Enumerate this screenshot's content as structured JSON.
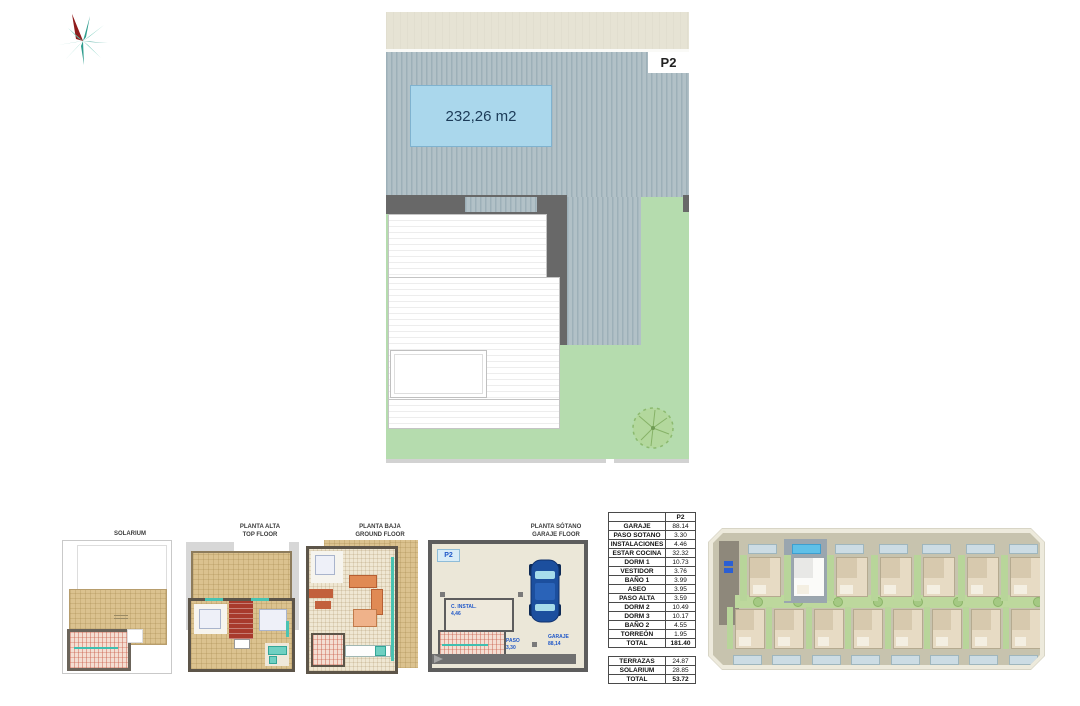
{
  "site_plan": {
    "plot_badge": "P2",
    "area_label": "232,26 m2"
  },
  "floor_plans": {
    "solarium": {
      "title1": "SOLARIUM",
      "title2": ""
    },
    "alta": {
      "title1": "PLANTA ALTA",
      "title2": "TOP FLOOR"
    },
    "baja": {
      "title1": "PLANTA BAJA",
      "title2": "GROUND FLOOR"
    },
    "sotano": {
      "title1": "PLANTA SÓTANO",
      "title2": "GARAJE FLOOR",
      "badge": "P2",
      "labels": {
        "instal1": "C. INSTAL.",
        "instal2": "4,46",
        "paso1": "PASO",
        "paso2": "3,30",
        "garaje1": "GARAJE",
        "garaje2": "88,14"
      }
    }
  },
  "areas_table": {
    "header": "P2",
    "rows": [
      {
        "label": "GARAJE",
        "value": "88.14"
      },
      {
        "label": "PASO SOTANO",
        "value": "3.30"
      },
      {
        "label": "INSTALACIONES",
        "value": "4.46"
      },
      {
        "label": "ESTAR COCINA",
        "value": "32.32"
      },
      {
        "label": "DORM 1",
        "value": "10.73"
      },
      {
        "label": "VESTIDOR",
        "value": "3.76"
      },
      {
        "label": "BAÑO 1",
        "value": "3.99"
      },
      {
        "label": "ASEO",
        "value": "3.95"
      },
      {
        "label": "PASO ALTA",
        "value": "3.59"
      },
      {
        "label": "DORM 2",
        "value": "10.49"
      },
      {
        "label": "DORM 3",
        "value": "10.17"
      },
      {
        "label": "BAÑO 2",
        "value": "4.55"
      },
      {
        "label": "TORREÓN",
        "value": "1.95"
      },
      {
        "label": "TOTAL",
        "value": "181.40",
        "total": true
      }
    ],
    "rows2": [
      {
        "label": "TERRAZAS",
        "value": "24.87"
      },
      {
        "label": "SOLARIUM",
        "value": "28.85"
      },
      {
        "label": "TOTAL",
        "value": "53.72",
        "total": true
      }
    ]
  },
  "site_map": {
    "top_row_count": 7,
    "bottom_row_count": 8,
    "highlighted_plot": "P2",
    "highlighted_top_index": 1
  },
  "colors": {
    "roof_stripe": "#a9bac1",
    "roof_dark": "#686868",
    "grass": "#b5dcae",
    "pool": "#aad7ec",
    "street": "#e6e3d4",
    "tan_floor": "#dbc28f",
    "map_road": "#c7c3ae",
    "highlight_blue": "#5fc0e8"
  }
}
